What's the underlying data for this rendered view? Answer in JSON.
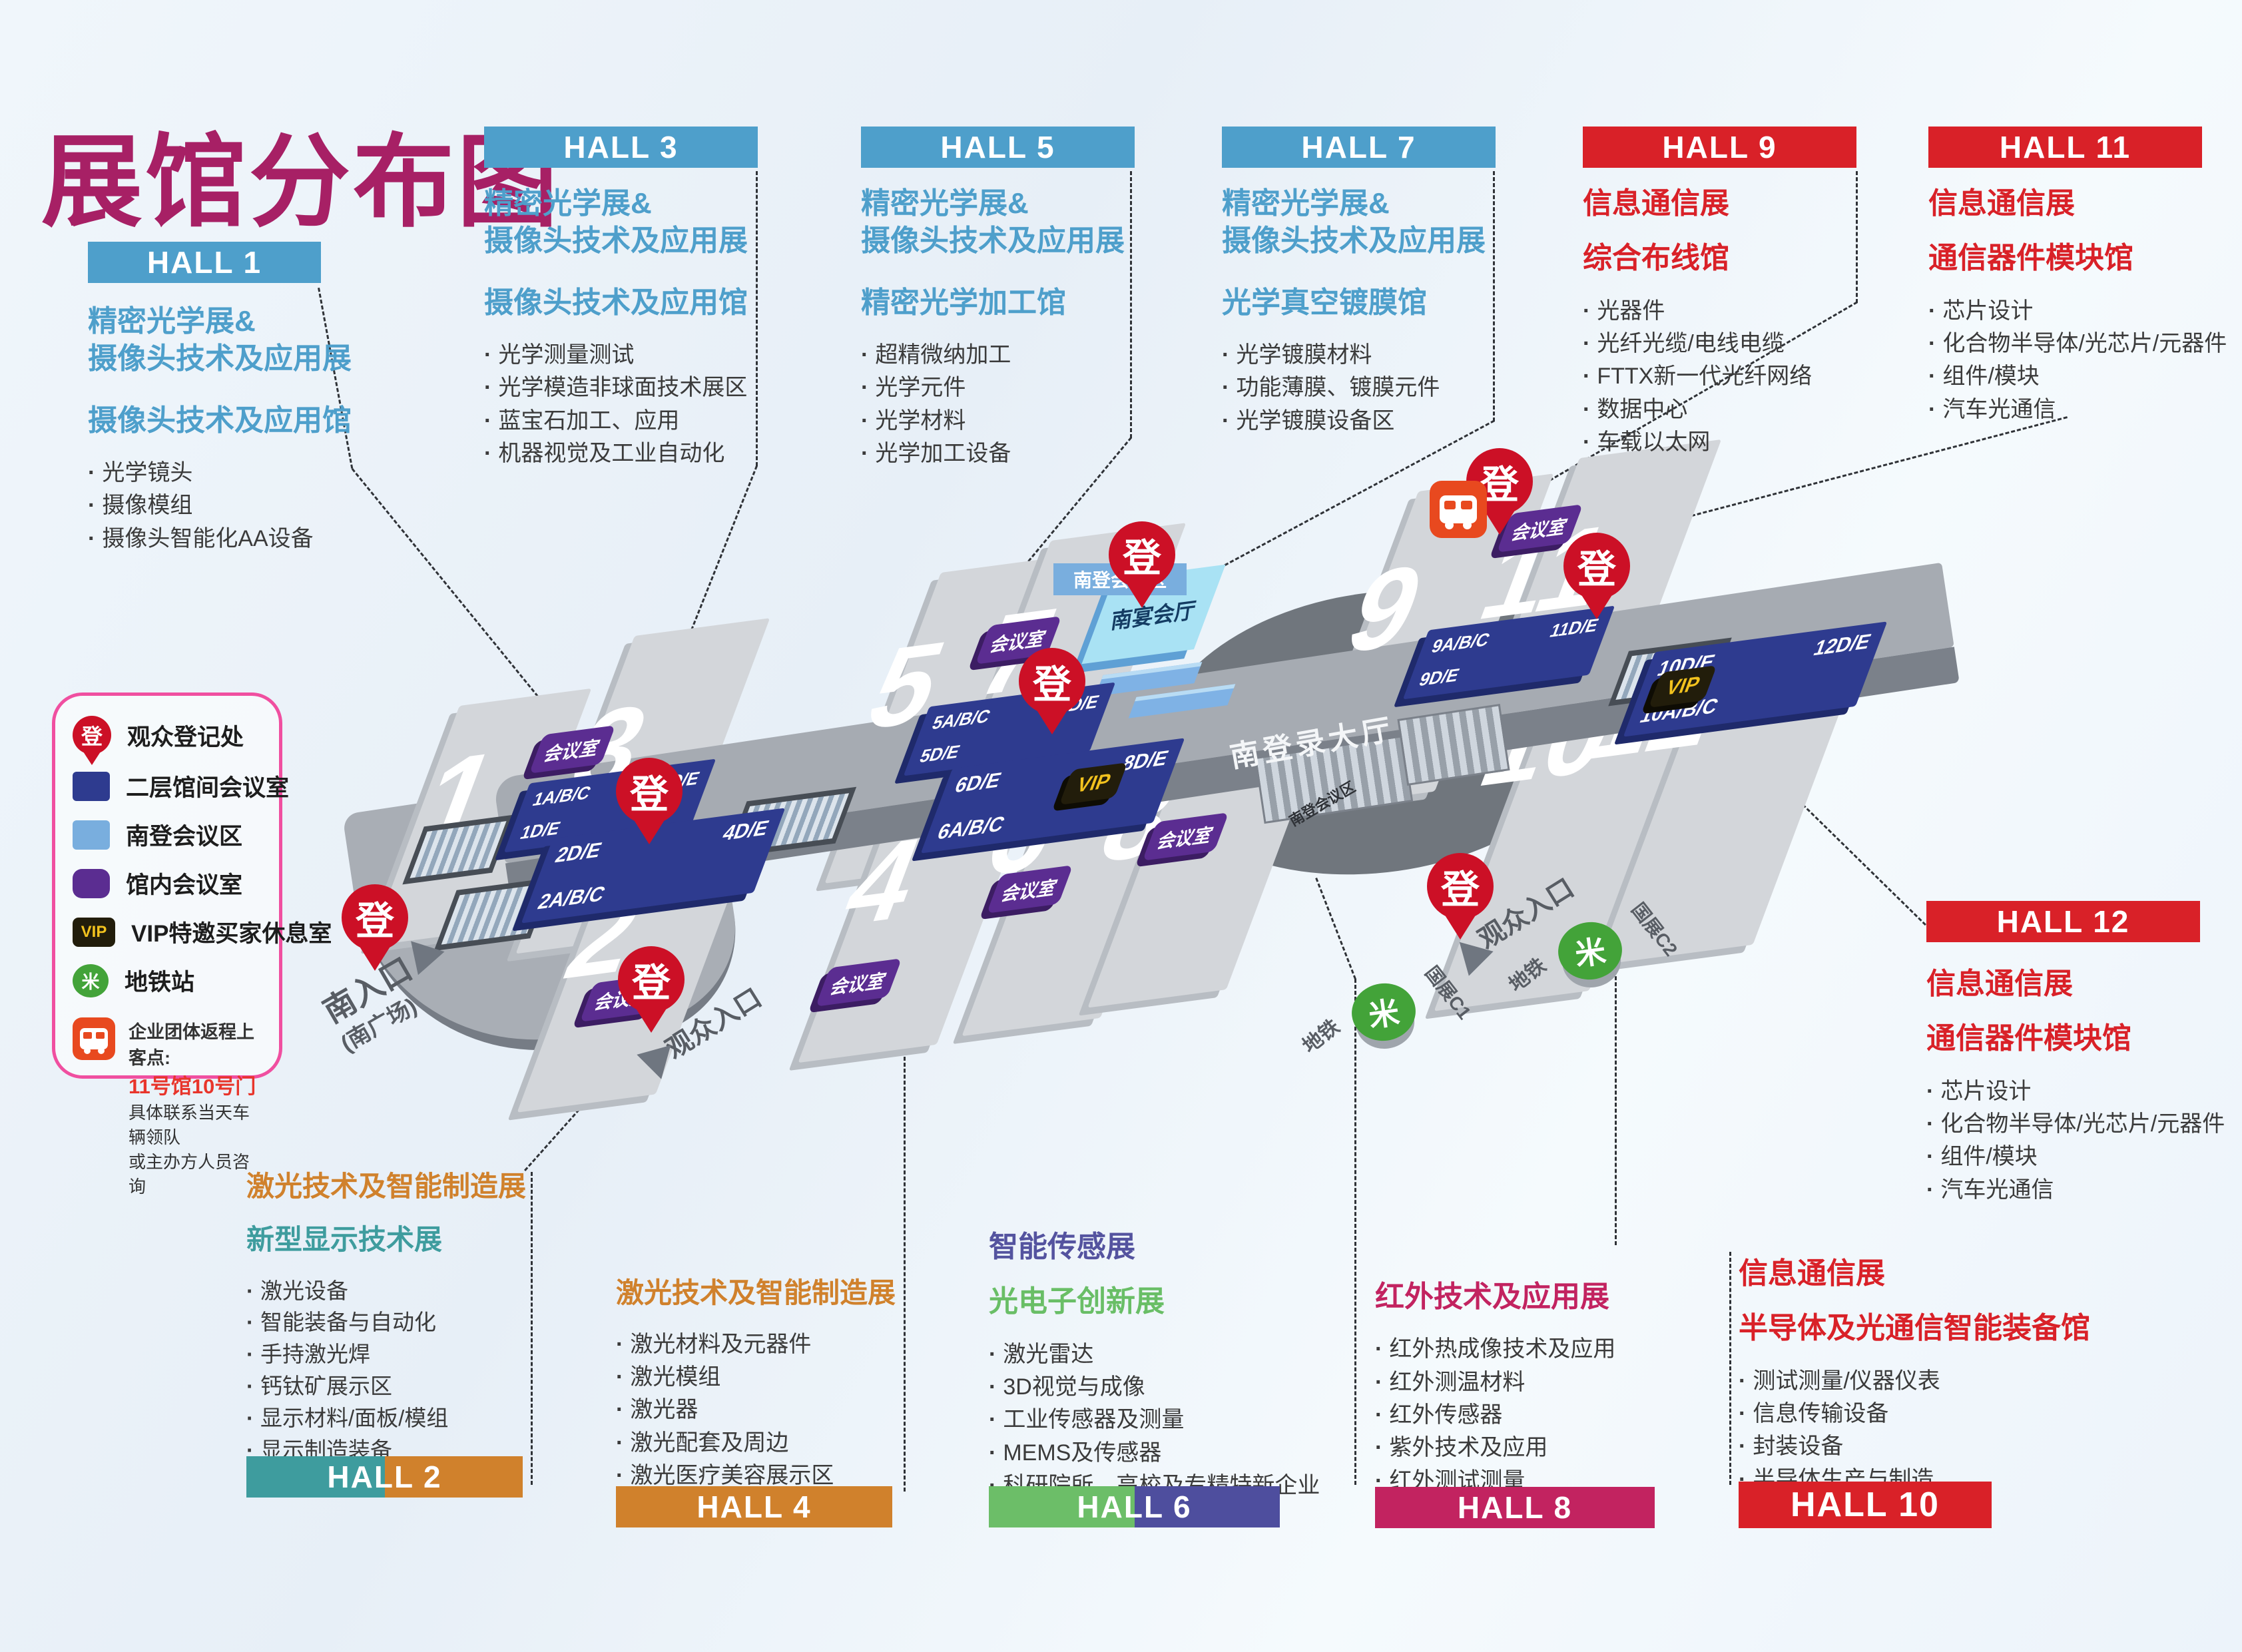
{
  "title": "展馆分布图",
  "colors": {
    "title": "#A72065",
    "blue": "#4E9FCB",
    "red": "#D92128",
    "orange": "#D0812C",
    "teal": "#3E9C9E",
    "indigo": "#54539F",
    "green": "#69BE66",
    "magenta": "#C22360",
    "navy_room": "#2E3B8F",
    "purple_room": "#5B2D91",
    "south_conf_blue": "#79AEDE",
    "pin_red": "#CC1026",
    "metro_green": "#43A339",
    "vip_gold": "#F2C21E",
    "bus_red": "#E8491F"
  },
  "blocks": {
    "hall1": {
      "header": "HALL 1",
      "t1a": "精密光学展&",
      "t1b": "摄像头技术及应用展",
      "t2": "摄像头技术及应用馆",
      "items": [
        "光学镜头",
        "摄像模组",
        "摄像头智能化AA设备"
      ]
    },
    "hall3": {
      "header": "HALL 3",
      "t1a": "精密光学展&",
      "t1b": "摄像头技术及应用展",
      "t2": "摄像头技术及应用馆",
      "items": [
        "光学测量测试",
        "光学模造非球面技术展区",
        "蓝宝石加工、应用",
        "机器视觉及工业自动化"
      ]
    },
    "hall5": {
      "header": "HALL 5",
      "t1a": "精密光学展&",
      "t1b": "摄像头技术及应用展",
      "t2": "精密光学加工馆",
      "items": [
        "超精微纳加工",
        "光学元件",
        "光学材料",
        "光学加工设备"
      ]
    },
    "hall7": {
      "header": "HALL 7",
      "t1a": "精密光学展&",
      "t1b": "摄像头技术及应用展",
      "t2": "光学真空镀膜馆",
      "items": [
        "光学镀膜材料",
        "功能薄膜、镀膜元件",
        "光学镀膜设备区"
      ]
    },
    "hall9": {
      "header": "HALL 9",
      "t1": "信息通信展",
      "t2": "综合布线馆",
      "items": [
        "光器件",
        "光纤光缆/电线电缆",
        "FTTX新一代光纤网络",
        "数据中心",
        "车载以太网"
      ]
    },
    "hall11": {
      "header": "HALL 11",
      "t1": "信息通信展",
      "t2": "通信器件模块馆",
      "items": [
        "芯片设计",
        "化合物半导体/光芯片/元器件",
        "组件/模块",
        "汽车光通信"
      ]
    },
    "hall12": {
      "header": "HALL 12",
      "t1": "信息通信展",
      "t2": "通信器件模块馆",
      "items": [
        "芯片设计",
        "化合物半导体/光芯片/元器件",
        "组件/模块",
        "汽车光通信"
      ]
    },
    "hall2": {
      "header": "HALL 2",
      "t1": "激光技术及智能制造展",
      "t2": "新型显示技术展",
      "items": [
        "激光设备",
        "智能装备与自动化",
        "手持激光焊",
        "钙钛矿展示区",
        "显示材料/面板/模组",
        "显示制造装备",
        "AR/VR产品及创新应用"
      ]
    },
    "hall4": {
      "header": "HALL 4",
      "t1": "激光技术及智能制造展",
      "items": [
        "激光材料及元器件",
        "激光模组",
        "激光器",
        "激光配套及周边",
        "激光医疗美容展示区"
      ]
    },
    "hall6": {
      "header": "HALL 6",
      "t1": "智能传感展",
      "t2": "光电子创新展",
      "items": [
        "激光雷达",
        "3D视觉与成像",
        "工业传感器及测量",
        "MEMS及传感器",
        "科研院所、高校及专精特新企业"
      ]
    },
    "hall8": {
      "header": "HALL 8",
      "t1": "红外技术及应用展",
      "items": [
        "红外热成像技术及应用",
        "红外测温材料",
        "红外传感器",
        "紫外技术及应用",
        "红外测试测量"
      ]
    },
    "hall10": {
      "header": "HALL 10",
      "t1": "信息通信展",
      "t2": "半导体及光通信智能装备馆",
      "items": [
        "测试测量/仪器仪表",
        "信息传输设备",
        "封装设备",
        "半导体生产与制造"
      ]
    }
  },
  "legend": {
    "items": [
      {
        "icon": "reg-pin",
        "label": "观众登记处"
      },
      {
        "icon": "navy-square",
        "label": "二层馆间会议室"
      },
      {
        "icon": "lightblue-square",
        "label": "南登会议区"
      },
      {
        "icon": "purple-square",
        "label": "馆内会议室"
      },
      {
        "icon": "vip-badge",
        "label": "VIP特邀买家休息室"
      },
      {
        "icon": "metro",
        "label": "地铁站"
      }
    ],
    "note_line1": "企业团体返程上客点:",
    "note_line2": "11号馆10号门",
    "note_line3": "具体联系当天车辆领队",
    "note_line4": "或主办方人员咨询"
  },
  "map": {
    "halls": [
      "1",
      "2",
      "3",
      "4",
      "5",
      "6",
      "7",
      "8",
      "9",
      "10",
      "11",
      "12"
    ],
    "bars": {
      "b13": [
        "1A/B/C",
        "3D/E",
        "1D/E"
      ],
      "b24": [
        "2D/E",
        "4D/E",
        "2A/B/C"
      ],
      "b57": [
        "5A/B/C",
        "7D/E",
        "5D/E"
      ],
      "b68": [
        "6D/E",
        "8D/E",
        "6A/B/C"
      ],
      "b911": [
        "9A/B/C",
        "11D/E",
        "9D/E"
      ],
      "b1012": [
        "10D/E",
        "12D/E",
        "10A/B/C"
      ]
    },
    "labels": {
      "reg": "登",
      "meeting": "会议室",
      "vip": "VIP",
      "banquet": "南宴会厅",
      "south_conf": "南登会议区",
      "reg_hall": "南登录大厅",
      "south_entrance": "南入口",
      "south_square": "(南广场)",
      "visitor": "观众入口",
      "metro": "地铁",
      "c1": "国展C1",
      "c2": "国展C2",
      "metro_glyph": "米"
    }
  }
}
